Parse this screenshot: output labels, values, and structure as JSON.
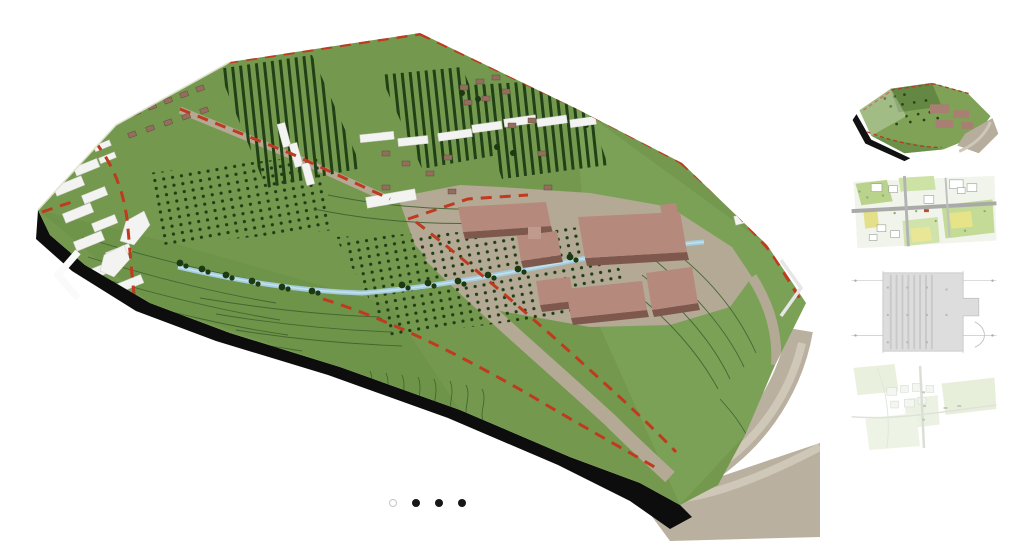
{
  "page": {
    "background_color": "#ffffff"
  },
  "main_image": {
    "alt": "3D aerial site model: green sloped terrain with contour lines, red dashed site boundary, rows of trees and orchards, white and brown buildings, mauve factory halls on a tan apron, a blue stream, black model edge and tan base plate",
    "colors": {
      "terrain_green": "#74994e",
      "terrain_light_green": "#7ea65c",
      "tree_dark_green": "#204016",
      "contour_green": "#3f6030",
      "boundary_red": "#bf3a1f",
      "building_mauve": "#b5897c",
      "house_brown": "#936d5e",
      "building_white": "#f3f3f1",
      "road_tan": "#b3a995",
      "base_plate_tan": "#b9b09f",
      "loop_road_tan": "#cfc7b8",
      "stream_blue": "#a5cddd",
      "model_edge_black": "#0d0d0d"
    }
  },
  "carousel": {
    "prev_icon": "chevron-left",
    "next_icon": "chevron-right",
    "prev_label": "Previous image",
    "next_label": "Next image",
    "dot_count": 4,
    "active_index": 0,
    "dots": [
      {
        "index": 1,
        "style": "outlined",
        "active": true,
        "label": "Go to image 1"
      },
      {
        "index": 2,
        "style": "filled",
        "active": false,
        "label": "Go to image 2"
      },
      {
        "index": 3,
        "style": "filled",
        "active": false,
        "label": "Go to image 3"
      },
      {
        "index": 4,
        "style": "filled",
        "active": false,
        "label": "Go to image 4"
      }
    ],
    "dot_colors": {
      "outlined_ring": "#c6c6c6",
      "filled": "#171717"
    }
  },
  "sidebar": {
    "thumbnails": [
      {
        "index": 1,
        "alt": "Thumbnail: 3D green site model with mauve buildings and tan base"
      },
      {
        "index": 2,
        "alt": "Thumbnail: colored master plan with green and yellow zones and gray roads"
      },
      {
        "index": 3,
        "alt": "Thumbnail: gray technical roof plan with grid lines and hatching"
      },
      {
        "index": 4,
        "alt": "Thumbnail: faded pale-green site plan with faint building outlines"
      }
    ]
  }
}
